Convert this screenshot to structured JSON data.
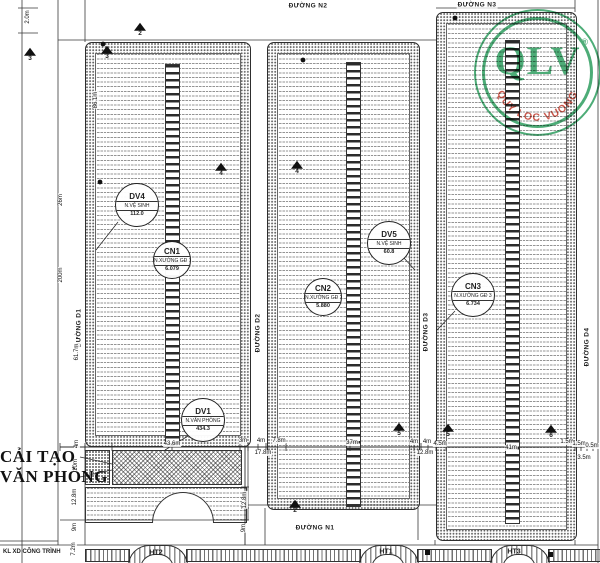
{
  "stamp": {
    "brand": "QLV",
    "registered": "®",
    "tagline": "QUY LOC VUONG"
  },
  "annotations": {
    "reno_line1": "CẢI TẠO",
    "reno_line2": "VĂN PHÒNG",
    "title_block": "KL XD CÔNG TRÌNH"
  },
  "roads": {
    "n1": "ĐƯỜNG N1",
    "n2": "ĐƯỜNG N2",
    "n3": "ĐƯỜNG N3",
    "d1": "ĐƯỜNG D1",
    "d2": "ĐƯỜNG D2",
    "d3": "ĐƯỜNG D3",
    "d4": "ĐƯỜNG D4"
  },
  "balloons": [
    {
      "code": "DV4",
      "name": "N.VỆ SINH",
      "area": "112.0"
    },
    {
      "code": "CN1",
      "name": "N.XƯỞNG GĐ 1",
      "area": "6.079"
    },
    {
      "code": "DV5",
      "name": "N.VỆ SINH",
      "area": "60.8"
    },
    {
      "code": "CN2",
      "name": "N.XƯỞNG GĐ 2",
      "area": "5.880"
    },
    {
      "code": "CN3",
      "name": "N.XƯỞNG GĐ 3",
      "area": "6.734"
    },
    {
      "code": "DV1",
      "name": "N.VĂN PHÒNG",
      "area": "434.3"
    }
  ],
  "structures": [
    {
      "label": "HT2"
    },
    {
      "label": "HT1"
    },
    {
      "label": "HT3"
    }
  ],
  "markers": [
    {
      "n": "3"
    },
    {
      "n": "3"
    },
    {
      "n": "2"
    },
    {
      "n": "4"
    },
    {
      "n": "4"
    },
    {
      "n": "5"
    },
    {
      "n": "5"
    },
    {
      "n": "6"
    },
    {
      "n": "2"
    }
  ],
  "dims": {
    "left": [
      "2.0m",
      "86.1m",
      "26m",
      "200m",
      "61.7m",
      "4m",
      "10m",
      "12.8m",
      "9m",
      "7.2m"
    ],
    "inner": [
      "12.8m",
      "9m"
    ],
    "bottom": [
      "43.6m",
      "3m",
      "4m",
      "7.8m",
      "17.8m",
      "37m",
      "4m",
      "4m",
      "4.5m",
      "12.8m",
      "41m",
      "1.5m",
      "1.5m",
      "0.5m",
      "3.5m"
    ]
  },
  "colors": {
    "stamp_green": "#2e9d5f",
    "stamp_red": "#c0392b",
    "line": "#2e2e2e"
  }
}
